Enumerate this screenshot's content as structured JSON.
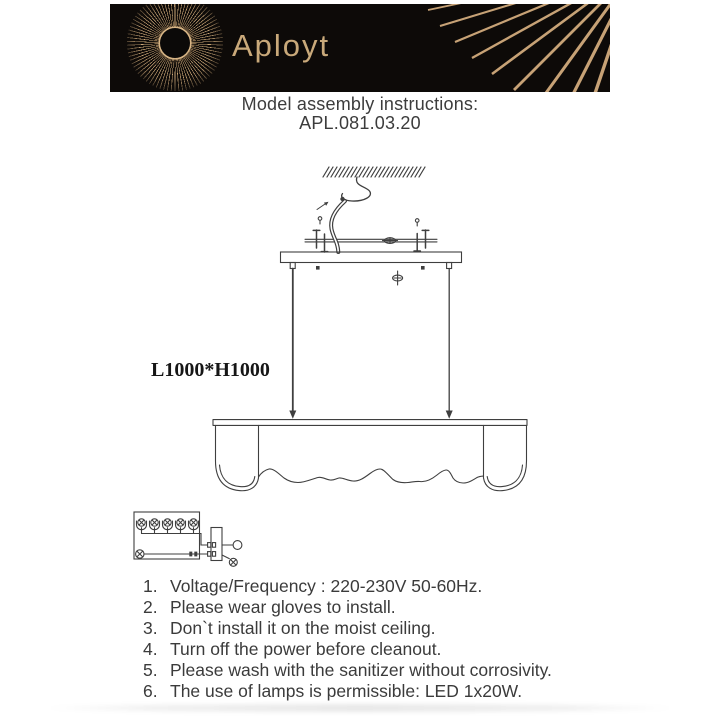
{
  "brand": {
    "name": "Aployt",
    "logo_icon": "sunburst-rays-icon"
  },
  "header": {
    "title": "Model assembly instructions:",
    "model": "APL.081.03.20"
  },
  "diagram": {
    "dimension_label": "L1000*H1000"
  },
  "instructions": {
    "items": [
      {
        "num": "1.",
        "text": "Voltage/Frequency : 220-230V 50-60Hz."
      },
      {
        "num": "2.",
        "text": "Please wear gloves to install."
      },
      {
        "num": "3.",
        "text": "Don`t install it on the moist ceiling."
      },
      {
        "num": "4.",
        "text": "Turn off the power before cleanout."
      },
      {
        "num": "5.",
        "text": "Please wash with the sanitizer without corrosivity."
      },
      {
        "num": "6.",
        "text": "The use of lamps is permissible: LED 1x20W."
      }
    ]
  },
  "colors": {
    "banner_bg": "#0d0a08",
    "brand_gold": "#c9a97a",
    "ray_gold": "#d2ab7c",
    "line": "#3f3f3f",
    "text": "#3b3b3b"
  }
}
